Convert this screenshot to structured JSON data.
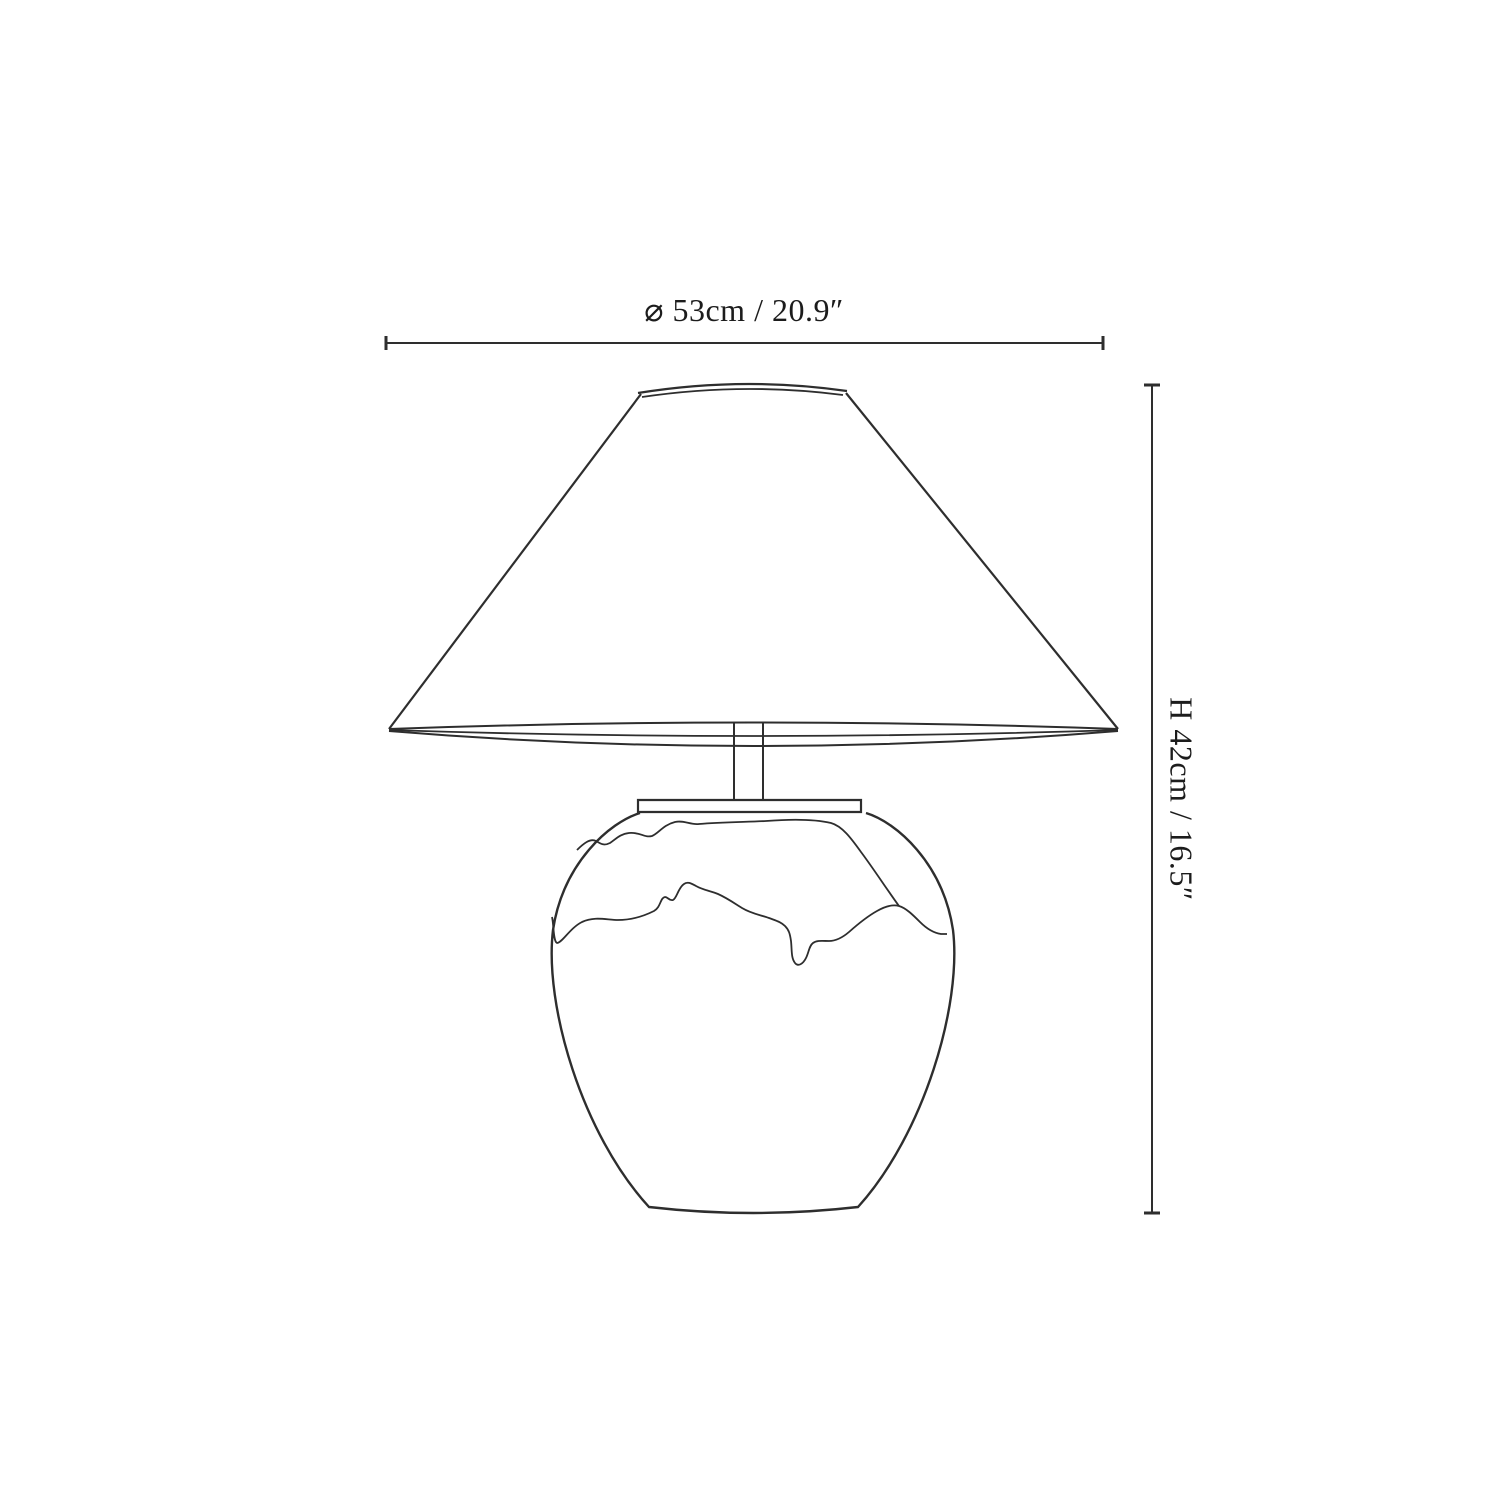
{
  "page": {
    "background_color": "#ffffff"
  },
  "drawing": {
    "colors": {
      "line": "#2e2e2e",
      "text": "#1c1c1c"
    },
    "width_dimension": {
      "symbol": "⌀",
      "metric": "53cm",
      "imperial": "20.9″",
      "label": "⌀ 53cm / 20.9″"
    },
    "height_dimension": {
      "prefix": "H",
      "metric": "42cm",
      "imperial": "16.5″",
      "label": "H 42cm / 16.5″"
    }
  }
}
